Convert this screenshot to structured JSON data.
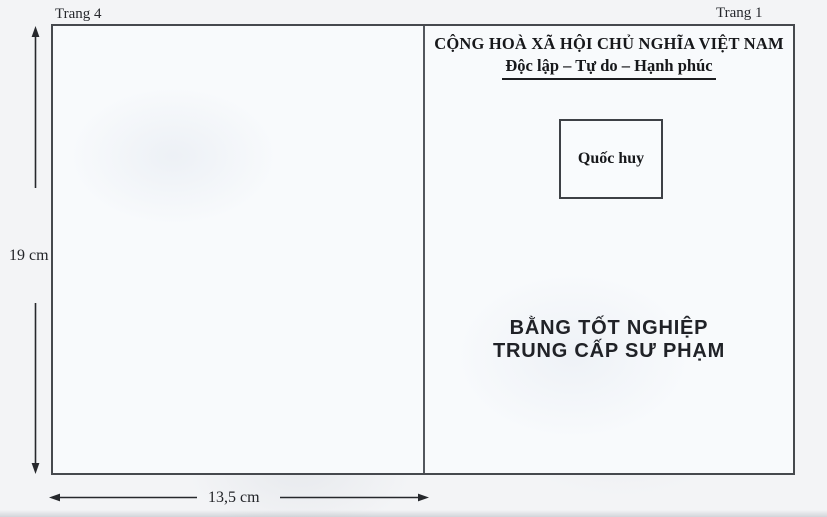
{
  "annotations": {
    "page_label_left": "Trang 4",
    "page_label_right": "Trang 1",
    "height_dimension": "19 cm",
    "width_dimension": "13,5 cm"
  },
  "cover": {
    "header": {
      "line1": "CỘNG HOÀ XÃ HỘI CHỦ NGHĨA VIỆT NAM",
      "motto": "Độc lập – Tự do – Hạnh phúc"
    },
    "emblem_label": "Quốc huy",
    "title": {
      "line1": "BẰNG TỐT NGHIỆP",
      "line2": "TRUNG CẤP SƯ PHẠM"
    }
  },
  "colors": {
    "outline": "#46494e",
    "arrow": "#26282c",
    "text": "#17181b",
    "paper_outer": "#f3f4f6",
    "paper_inner": "#f8fafc"
  }
}
